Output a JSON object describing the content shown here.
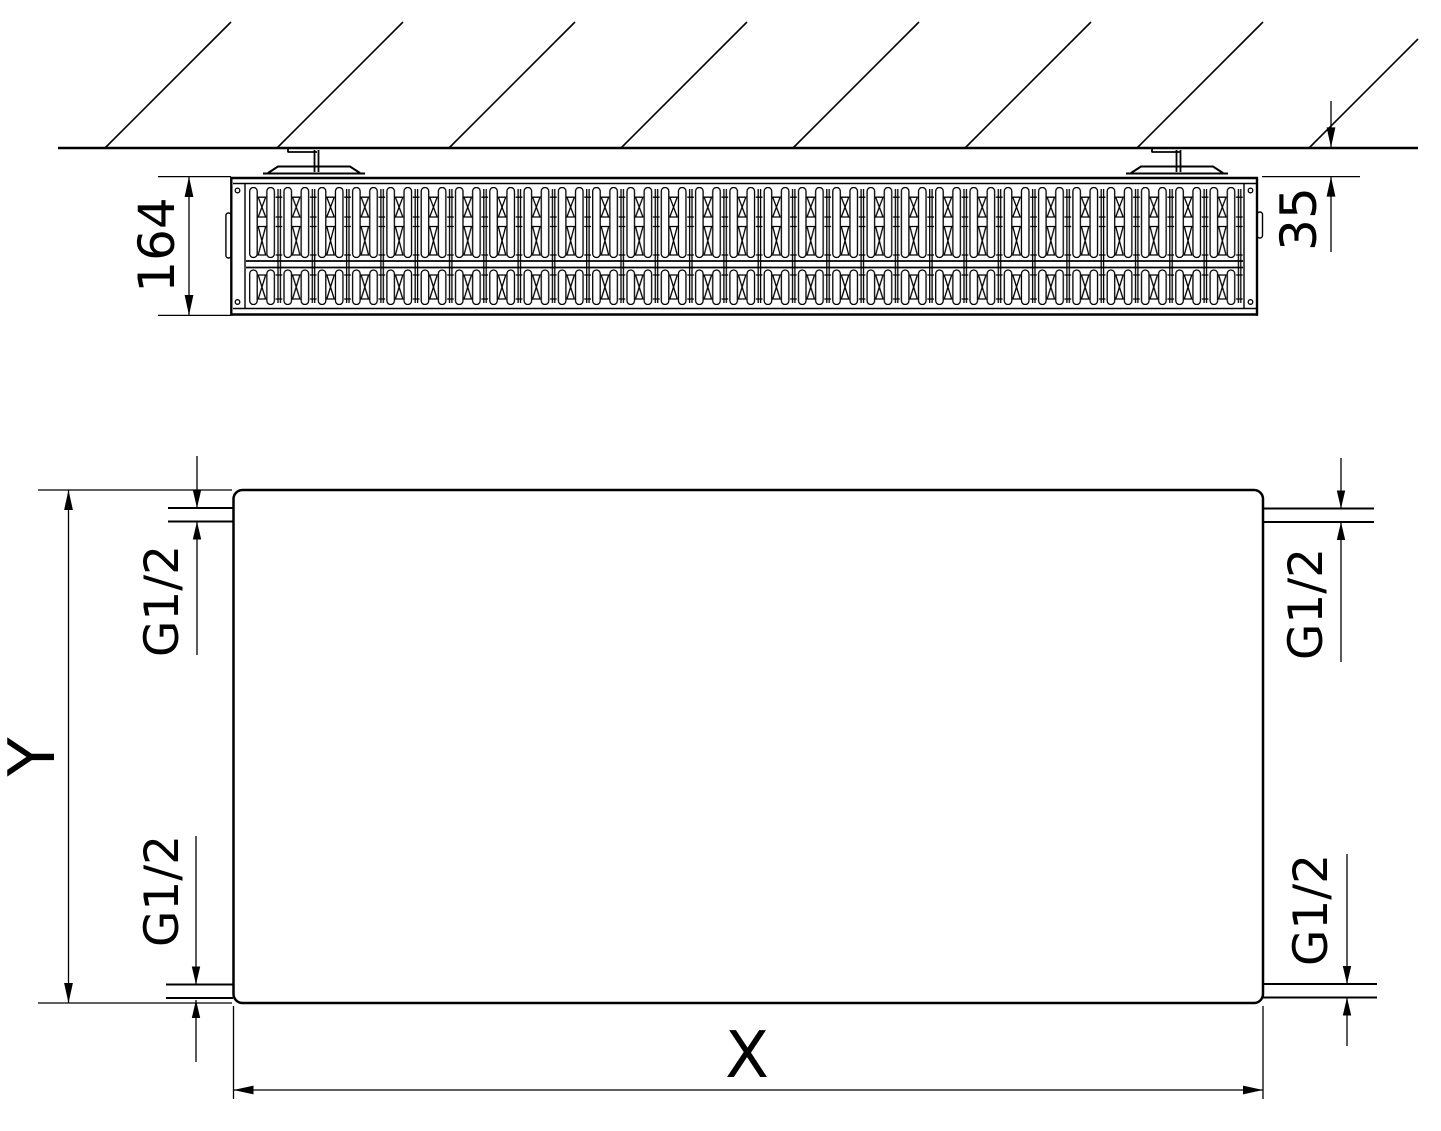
{
  "drawing": {
    "kind": "radiator technical dimension drawing",
    "colors": {
      "line": "#000000",
      "background": "#ffffff"
    }
  },
  "top_view": {
    "depth_dim": "164",
    "wall_gap_dim": "35"
  },
  "front_view": {
    "height_dim": "Y",
    "width_dim": "X",
    "connections": [
      {
        "position": "top-left",
        "label": "G1/2"
      },
      {
        "position": "bottom-left",
        "label": "G1/2"
      },
      {
        "position": "top-right",
        "label": "G1/2"
      },
      {
        "position": "bottom-right",
        "label": "G1/2"
      }
    ]
  }
}
